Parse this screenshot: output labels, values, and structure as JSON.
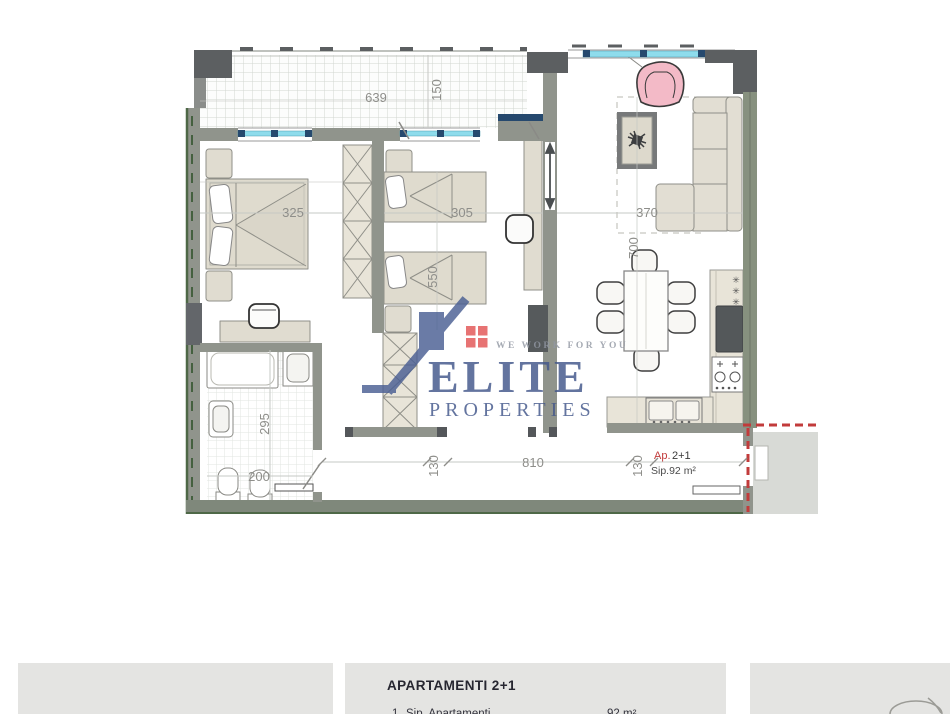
{
  "watermark": {
    "brand": "ELITE",
    "brand_line2": "PROPERTIES",
    "tagline": "WE WORK FOR YOU",
    "brand_color": "#42568a",
    "accent_red": "#e25555"
  },
  "plan": {
    "unit_label": {
      "prefix": "Ap.",
      "unit": "2+1",
      "area": "Sip.92 m²",
      "prefix_color": "#c23b3b"
    },
    "dims": {
      "balcony_width": "639",
      "balcony_depth": "150",
      "bedroom1_width": "325",
      "bedroom2_width": "305",
      "bedroom2_length": "550",
      "living_width": "370",
      "living_length": "700",
      "bath_length": "295",
      "bath_width": "200",
      "hall_seg_left": "130",
      "hall_length": "810",
      "hall_seg_right": "130"
    },
    "icons": {
      "asterisk": "✳"
    },
    "colors": {
      "window_cyan": "#8edcec",
      "window_navy": "#26496e",
      "wall_gray": "#909290",
      "wall_dark": "#5c5f61",
      "exterior_green": "#7f887b",
      "armchair_pink": "#f3bac7",
      "boundary_red": "#c23b3b"
    }
  },
  "footer": {
    "title": "APARTAMENTI 2+1",
    "row": {
      "index": "1.",
      "label": "Sip. Apartamenti",
      "value": "92 m²"
    }
  }
}
